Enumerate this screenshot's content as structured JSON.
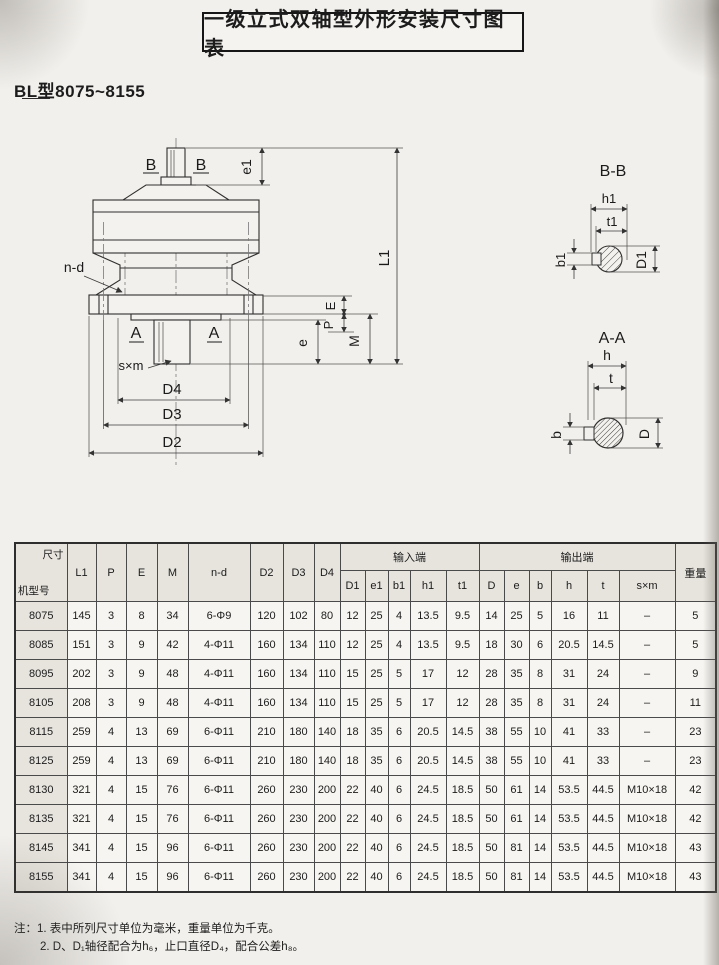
{
  "page": {
    "title": "一级立式双轴型外形安装尺寸图表",
    "subtitle": "BL型8075~8155",
    "note1": "注：1. 表中所列尺寸单位为毫米，重量单位为千克。",
    "note2": "2. D、D₁轴径配合为h₆，止口直径D₄，配合公差h₈。"
  },
  "drawing": {
    "labels": {
      "b": "B",
      "a": "A",
      "nd": "n-d",
      "sxm": "s×m",
      "e1": "e1",
      "l1": "L1",
      "E": "E",
      "P": "P",
      "M": "M",
      "e": "e",
      "d4": "D4",
      "d3": "D3",
      "d2": "D2",
      "bb_title": "B-B",
      "h1": "h1",
      "t1": "t1",
      "b1": "b1",
      "D1": "D1",
      "aa_title": "A-A",
      "h": "h",
      "t": "t",
      "bsec": "b",
      "Dsec": "D"
    }
  },
  "table": {
    "corner": {
      "top": "尺寸",
      "bottom": "机型号"
    },
    "columns": [
      "L1",
      "P",
      "E",
      "M",
      "n-d",
      "D2",
      "D3",
      "D4"
    ],
    "group_input": "输入端",
    "group_output": "输出端",
    "weight": "重量",
    "input_cols": [
      "D1",
      "e1",
      "b1",
      "h1",
      "t1"
    ],
    "output_cols": [
      "D",
      "e",
      "b",
      "h",
      "t",
      "s×m"
    ],
    "rows": [
      [
        "8075",
        "145",
        "3",
        "8",
        "34",
        "6-Φ9",
        "120",
        "102",
        "80",
        "12",
        "25",
        "4",
        "13.5",
        "9.5",
        "14",
        "25",
        "5",
        "16",
        "11",
        "–",
        "5"
      ],
      [
        "8085",
        "151",
        "3",
        "9",
        "42",
        "4-Φ11",
        "160",
        "134",
        "110",
        "12",
        "25",
        "4",
        "13.5",
        "9.5",
        "18",
        "30",
        "6",
        "20.5",
        "14.5",
        "–",
        "5"
      ],
      [
        "8095",
        "202",
        "3",
        "9",
        "48",
        "4-Φ11",
        "160",
        "134",
        "110",
        "15",
        "25",
        "5",
        "17",
        "12",
        "28",
        "35",
        "8",
        "31",
        "24",
        "–",
        "9"
      ],
      [
        "8105",
        "208",
        "3",
        "9",
        "48",
        "4-Φ11",
        "160",
        "134",
        "110",
        "15",
        "25",
        "5",
        "17",
        "12",
        "28",
        "35",
        "8",
        "31",
        "24",
        "–",
        "11"
      ],
      [
        "8115",
        "259",
        "4",
        "13",
        "69",
        "6-Φ11",
        "210",
        "180",
        "140",
        "18",
        "35",
        "6",
        "20.5",
        "14.5",
        "38",
        "55",
        "10",
        "41",
        "33",
        "–",
        "23"
      ],
      [
        "8125",
        "259",
        "4",
        "13",
        "69",
        "6-Φ11",
        "210",
        "180",
        "140",
        "18",
        "35",
        "6",
        "20.5",
        "14.5",
        "38",
        "55",
        "10",
        "41",
        "33",
        "–",
        "23"
      ],
      [
        "8130",
        "321",
        "4",
        "15",
        "76",
        "6-Φ11",
        "260",
        "230",
        "200",
        "22",
        "40",
        "6",
        "24.5",
        "18.5",
        "50",
        "61",
        "14",
        "53.5",
        "44.5",
        "M10×18",
        "42"
      ],
      [
        "8135",
        "321",
        "4",
        "15",
        "76",
        "6-Φ11",
        "260",
        "230",
        "200",
        "22",
        "40",
        "6",
        "24.5",
        "18.5",
        "50",
        "61",
        "14",
        "53.5",
        "44.5",
        "M10×18",
        "42"
      ],
      [
        "8145",
        "341",
        "4",
        "15",
        "96",
        "6-Φ11",
        "260",
        "230",
        "200",
        "22",
        "40",
        "6",
        "24.5",
        "18.5",
        "50",
        "81",
        "14",
        "53.5",
        "44.5",
        "M10×18",
        "43"
      ],
      [
        "8155",
        "341",
        "4",
        "15",
        "96",
        "6-Φ11",
        "260",
        "230",
        "200",
        "22",
        "40",
        "6",
        "24.5",
        "18.5",
        "50",
        "81",
        "14",
        "53.5",
        "44.5",
        "M10×18",
        "43"
      ]
    ]
  }
}
